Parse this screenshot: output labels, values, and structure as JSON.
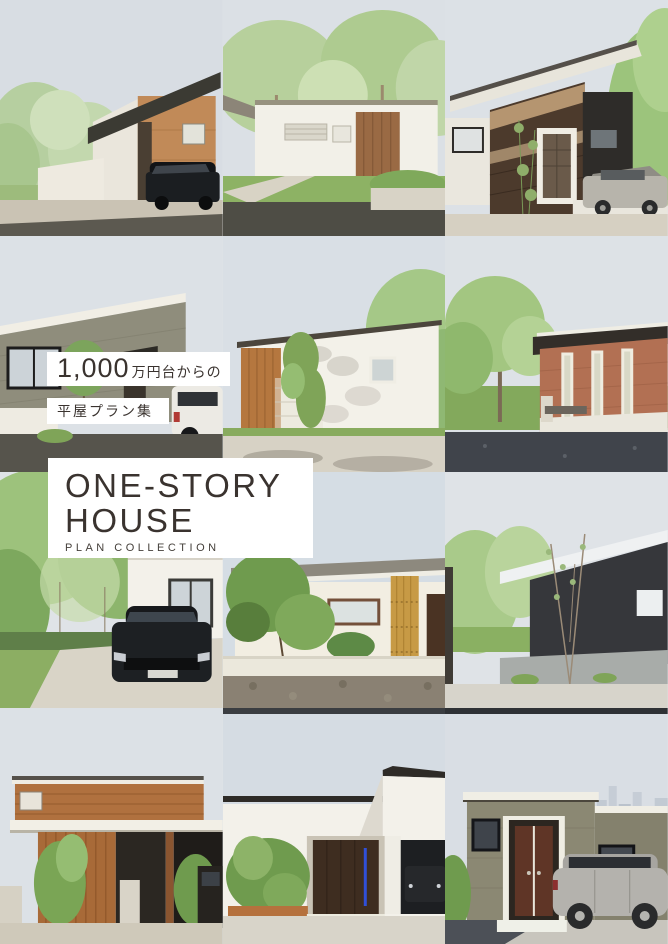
{
  "overlay": {
    "price": {
      "big": "1,000",
      "suffix": "万円台からの"
    },
    "subtitle": "平屋プラン集",
    "title": {
      "line1": "ONE-STORY",
      "line2": "HOUSE",
      "sub": "PLAN COLLECTION"
    }
  },
  "colors": {
    "text": "#3a332f",
    "box_bg": "#ffffff",
    "sky": "#dadfe5"
  },
  "photos": [
    {
      "desc": "House with dark mono-pitch roof, wood and brick facade, white garden wall, black SUV in driveway, trees on the left"
    },
    {
      "desc": "White flat-roof house with recessed wooden entrance, slatted window, front lawn and dark gravel court, tall trees behind"
    },
    {
      "desc": "Slant-roof house with dark wood cladding, white framed door, charcoal wing, silver car and tall greenery on the right"
    },
    {
      "desc": "Gray-green single-story house with rising roofline, black framed window, covered entrance and white car at right"
    },
    {
      "desc": "White brick house with rising roof edge, wooden slat wall and climbing greenery, tree shadows on the wall"
    },
    {
      "desc": "Red-brick flat-roof house with three tall slit windows, large tree and lawn on the left, dark asphalt in front"
    },
    {
      "desc": "White house surrounded by large green trees with a black SUV parked on a light driveway"
    },
    {
      "desc": "Japanese style house with low tiled roof, wooden lattice screen, dark brown door, garden tree and clipped shrub behind a low wall"
    },
    {
      "desc": "Charcoal house with white slanted roof edge, slender young tree in front, concrete base wall and open lawn to the left"
    },
    {
      "desc": "Wood-clad house with white canopy, vertical slat entrance screen, garden plants and a dark car at the right edge"
    },
    {
      "desc": "Minimalist white house with recessed dark wood entrance with blue handle light, open garage with parked car, shrub planter on the left"
    },
    {
      "desc": "Olive-brick house with white fascia, brown double door, silver SUV parked in front and a city skyline in the distance"
    }
  ]
}
